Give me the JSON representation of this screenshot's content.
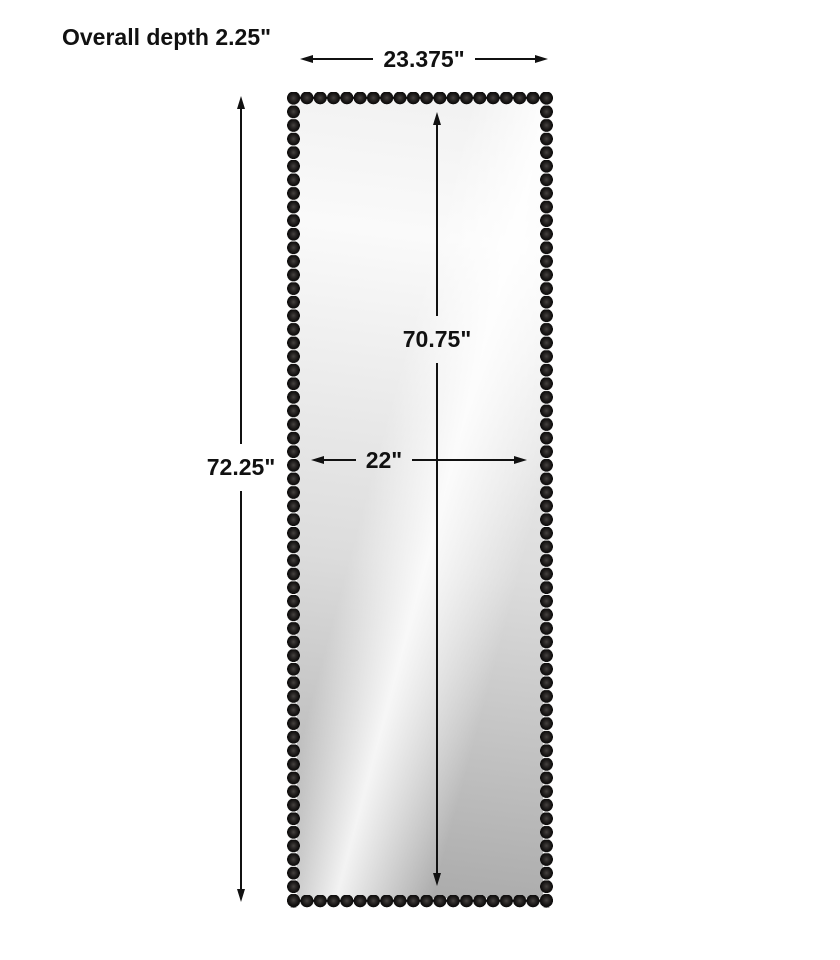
{
  "diagram": {
    "kind": "product-dimension-diagram",
    "labels": {
      "overall_depth": "Overall depth 2.25\"",
      "overall_width": "23.375\"",
      "overall_height": "72.25\"",
      "mirror_height": "70.75\"",
      "mirror_width": "22\""
    },
    "colors": {
      "background": "#ffffff",
      "line": "#111111",
      "text": "#111111",
      "bead_black": "#161413",
      "glass_light": "#fafafa",
      "glass_dark": "#a9a9a9"
    }
  }
}
